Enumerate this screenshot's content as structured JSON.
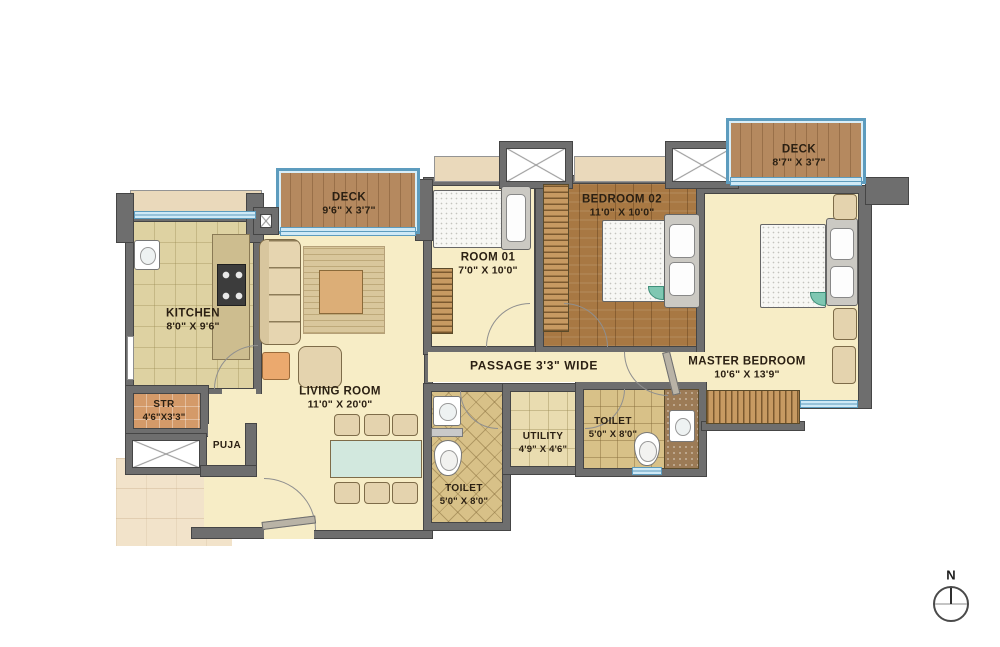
{
  "rooms": {
    "kitchen": {
      "name": "KITCHEN",
      "dims": "8'0\" X 9'6\""
    },
    "deck_left": {
      "name": "DECK",
      "dims": "9'6\" X 3'7\""
    },
    "room01": {
      "name": "ROOM 01",
      "dims": "7'0\" X 10'0\""
    },
    "bedroom02": {
      "name": "BEDROOM 02",
      "dims": "11'0\" X 10'0\""
    },
    "deck_right": {
      "name": "DECK",
      "dims": "8'7\" X 3'7\""
    },
    "master_bedroom": {
      "name": "MASTER BEDROOM",
      "dims": "10'6\" X 13'9\""
    },
    "living_room": {
      "name": "LIVING ROOM",
      "dims": "11'0\" X 20'0\""
    },
    "passage": {
      "name": "PASSAGE 3'3\" WIDE"
    },
    "str": {
      "name": "STR",
      "dims": "4'6\"X3'3\""
    },
    "puja": {
      "name": "PUJA"
    },
    "toilet_common": {
      "name": "TOILET",
      "dims": "5'0\" X 8'0\""
    },
    "utility": {
      "name": "UTILITY",
      "dims": "4'9\" X 4'6\""
    },
    "toilet_master": {
      "name": "TOILET",
      "dims": "5'0\" X 8'0\""
    }
  },
  "compass": {
    "label": "N"
  },
  "colors": {
    "wall": "#6e6e6e",
    "floor_cream": "#f7edc6",
    "deck_wood": "#b5895f",
    "window_blue": "#cfe9f6",
    "accent_teal": "#7fc7b2"
  }
}
